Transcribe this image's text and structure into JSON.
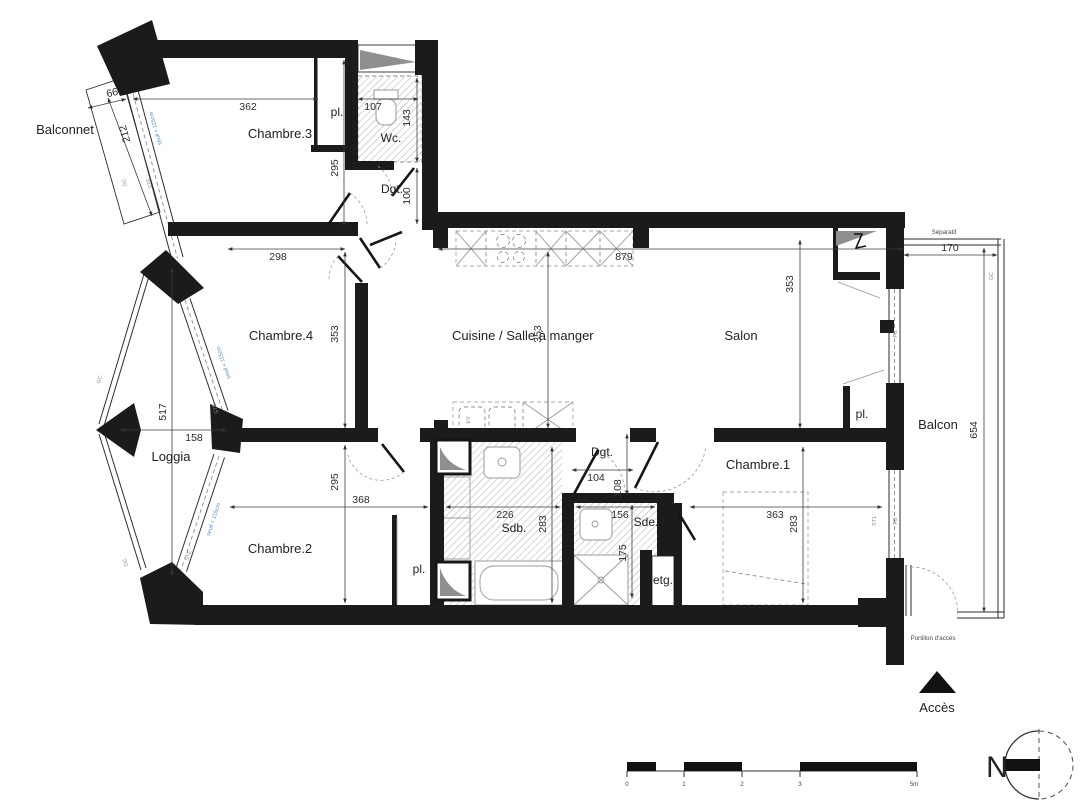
{
  "rooms": {
    "balconnet": "Balconnet",
    "chambre3": "Chambre.3",
    "pl1": "pl.",
    "wc": "Wc.",
    "dgt1": "Dgt.",
    "chambre4": "Chambre.4",
    "cuisine": "Cuisine / Salle à manger",
    "salon": "Salon",
    "pl2": "pl.",
    "loggia": "Loggia",
    "chambre2": "Chambre.2",
    "pl3": "pl.",
    "sdb": "Sdb.",
    "dgt2": "Dgt.",
    "sde": "Sde.",
    "etg": "etg.",
    "chambre1": "Chambre.1",
    "balcon": "Balcon",
    "acces": "Accès"
  },
  "dims": {
    "d66": "66",
    "d212": "212",
    "d362": "362",
    "d107": "107",
    "d143": "143",
    "d295a": "295",
    "d100": "100",
    "d298": "298",
    "d879": "879",
    "d353a": "353",
    "d353b": "353",
    "d353c": "353",
    "d170": "170",
    "d654": "654",
    "d517": "517",
    "d158": "158",
    "d295b": "295",
    "d368": "368",
    "d226": "226",
    "d283a": "283",
    "d104": "104",
    "d108": "108",
    "d156": "156",
    "d175": "175",
    "d363": "363",
    "d283b": "283"
  },
  "notes": {
    "separatif": "Séparatif",
    "portillon": "Portillon d'accès",
    "seuil": "seuil < 115cm",
    "gc": "GC",
    "ste": "STE",
    "st1": "ST1",
    "pb": "PB",
    "ev": "EV"
  },
  "scalebar": {
    "labels": [
      "0",
      "1",
      "2",
      "3",
      "5m"
    ]
  },
  "north": {
    "label": "N"
  },
  "colors": {
    "wall": "#1b1b1b",
    "blue": "#4e8fcb",
    "dimtext": "#2d2d2d",
    "bg": "#ffffff"
  }
}
